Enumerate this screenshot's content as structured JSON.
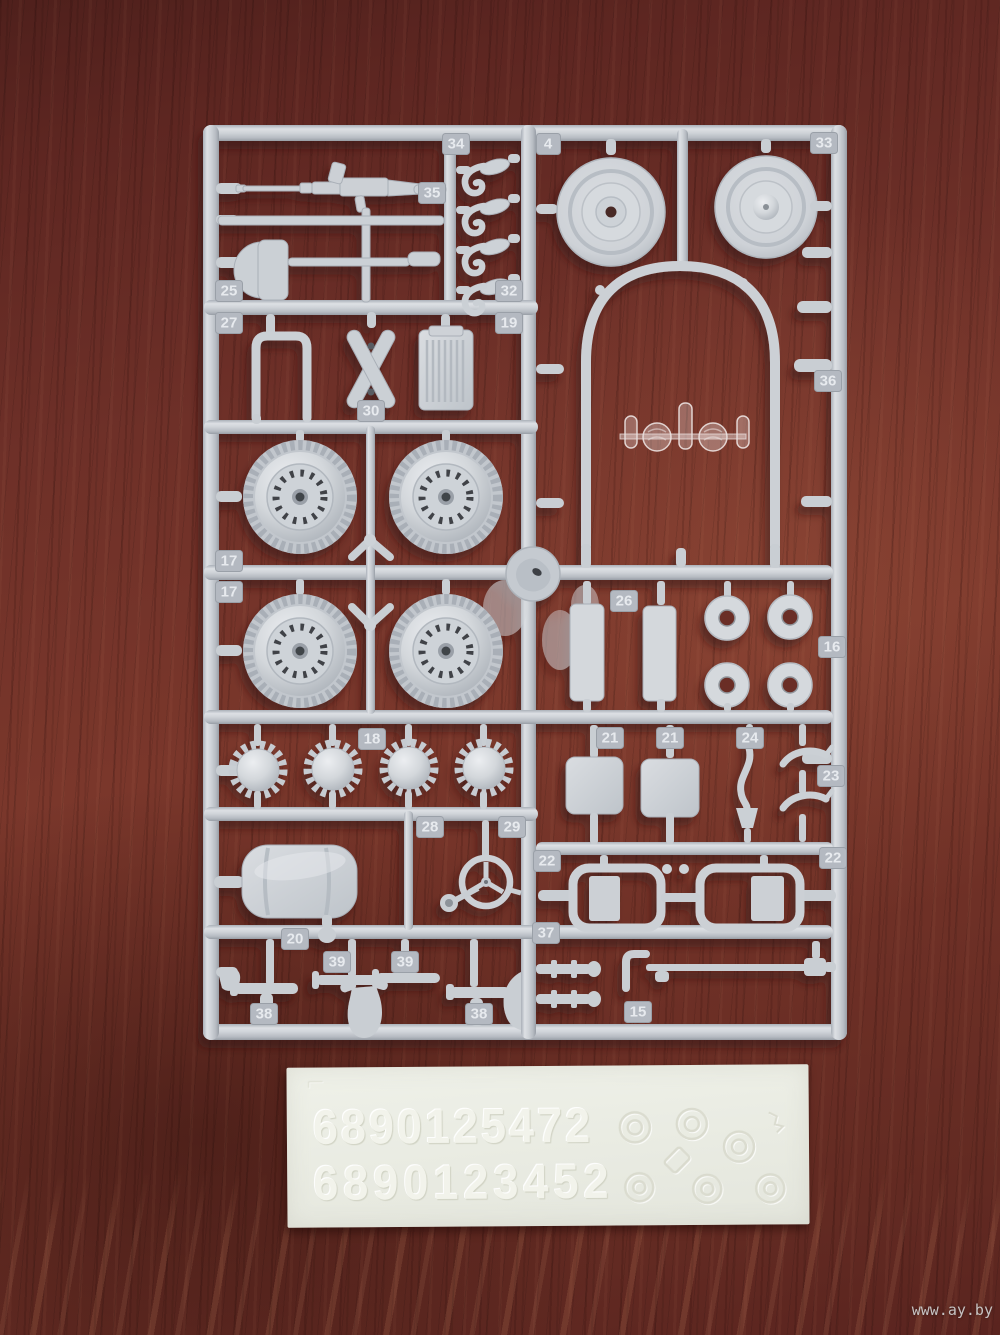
{
  "sprue": {
    "plastic_color": "#cdd1d6",
    "tags": [
      {
        "label": "34"
      },
      {
        "label": "4"
      },
      {
        "label": "33"
      },
      {
        "label": "35"
      },
      {
        "label": "25"
      },
      {
        "label": "32"
      },
      {
        "label": "27"
      },
      {
        "label": "19"
      },
      {
        "label": "30"
      },
      {
        "label": "36"
      },
      {
        "label": "17"
      },
      {
        "label": "17"
      },
      {
        "label": "26"
      },
      {
        "label": "16"
      },
      {
        "label": "18"
      },
      {
        "label": "21"
      },
      {
        "label": "21"
      },
      {
        "label": "24"
      },
      {
        "label": "23"
      },
      {
        "label": "28"
      },
      {
        "label": "29"
      },
      {
        "label": "22"
      },
      {
        "label": "22"
      },
      {
        "label": "37"
      },
      {
        "label": "20"
      },
      {
        "label": "39"
      },
      {
        "label": "39"
      },
      {
        "label": "38"
      },
      {
        "label": "38"
      },
      {
        "label": "15"
      }
    ]
  },
  "decal": {
    "row1": "6890125472",
    "row2": "6890123452",
    "paper_color": "#eaece4"
  },
  "watermark": {
    "text": "www.ay.by"
  },
  "colors": {
    "wood_base": "#6e3028",
    "wood_dark": "#4f201c",
    "wood_light": "#95523e",
    "plastic": "#cdd1d6",
    "plastic_shadow": "#a6acb3",
    "plastic_highlight": "#e9ebee",
    "tag_plate": "#b4b9c1",
    "tag_text": "#e7eaee"
  }
}
